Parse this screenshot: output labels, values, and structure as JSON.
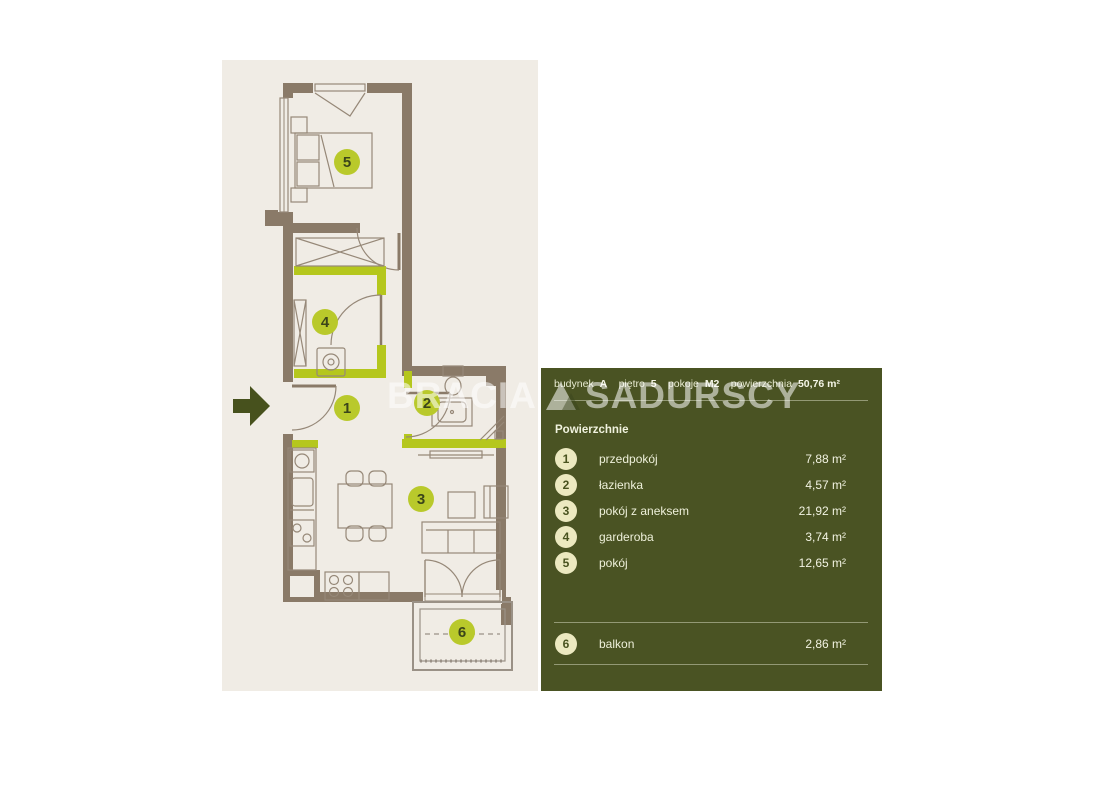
{
  "watermark": {
    "brand_left": "BRACIA",
    "brand_right": "SADURSCY",
    "logo": "triangle-mountain-icon"
  },
  "panel": {
    "header": {
      "items": [
        {
          "label": "budynek",
          "value": "A"
        },
        {
          "label": "piętro",
          "value": "5"
        },
        {
          "label": "pokoje",
          "value": "M2"
        },
        {
          "label": "powierzchnia",
          "value": "50,76 m²"
        }
      ]
    },
    "section_title": "Powierzchnie",
    "rooms": [
      {
        "num": "1",
        "name": "przedpokój",
        "area": "7,88 m²"
      },
      {
        "num": "2",
        "name": "łazienka",
        "area": "4,57 m²"
      },
      {
        "num": "3",
        "name": "pokój z aneksem",
        "area": "21,92 m²"
      },
      {
        "num": "4",
        "name": "garderoba",
        "area": "3,74 m²"
      },
      {
        "num": "5",
        "name": "pokój",
        "area": "12,65 m²"
      }
    ],
    "extra_rooms": [
      {
        "num": "6",
        "name": "balkon",
        "area": "2,86 m²"
      }
    ]
  },
  "floorplan": {
    "entrance_marker": "entrance-arrow",
    "room_markers": [
      "1",
      "2",
      "3",
      "4",
      "5",
      "6"
    ]
  },
  "colors": {
    "panel_green": "#4a5323",
    "wall_brown": "#8a7a68",
    "accent_lime": "#b5c71d",
    "marker_lime": "#b9c92b",
    "badge_cream": "#ece9c0",
    "plan_background": "#f0ece5",
    "furniture_stroke": "#968878"
  }
}
